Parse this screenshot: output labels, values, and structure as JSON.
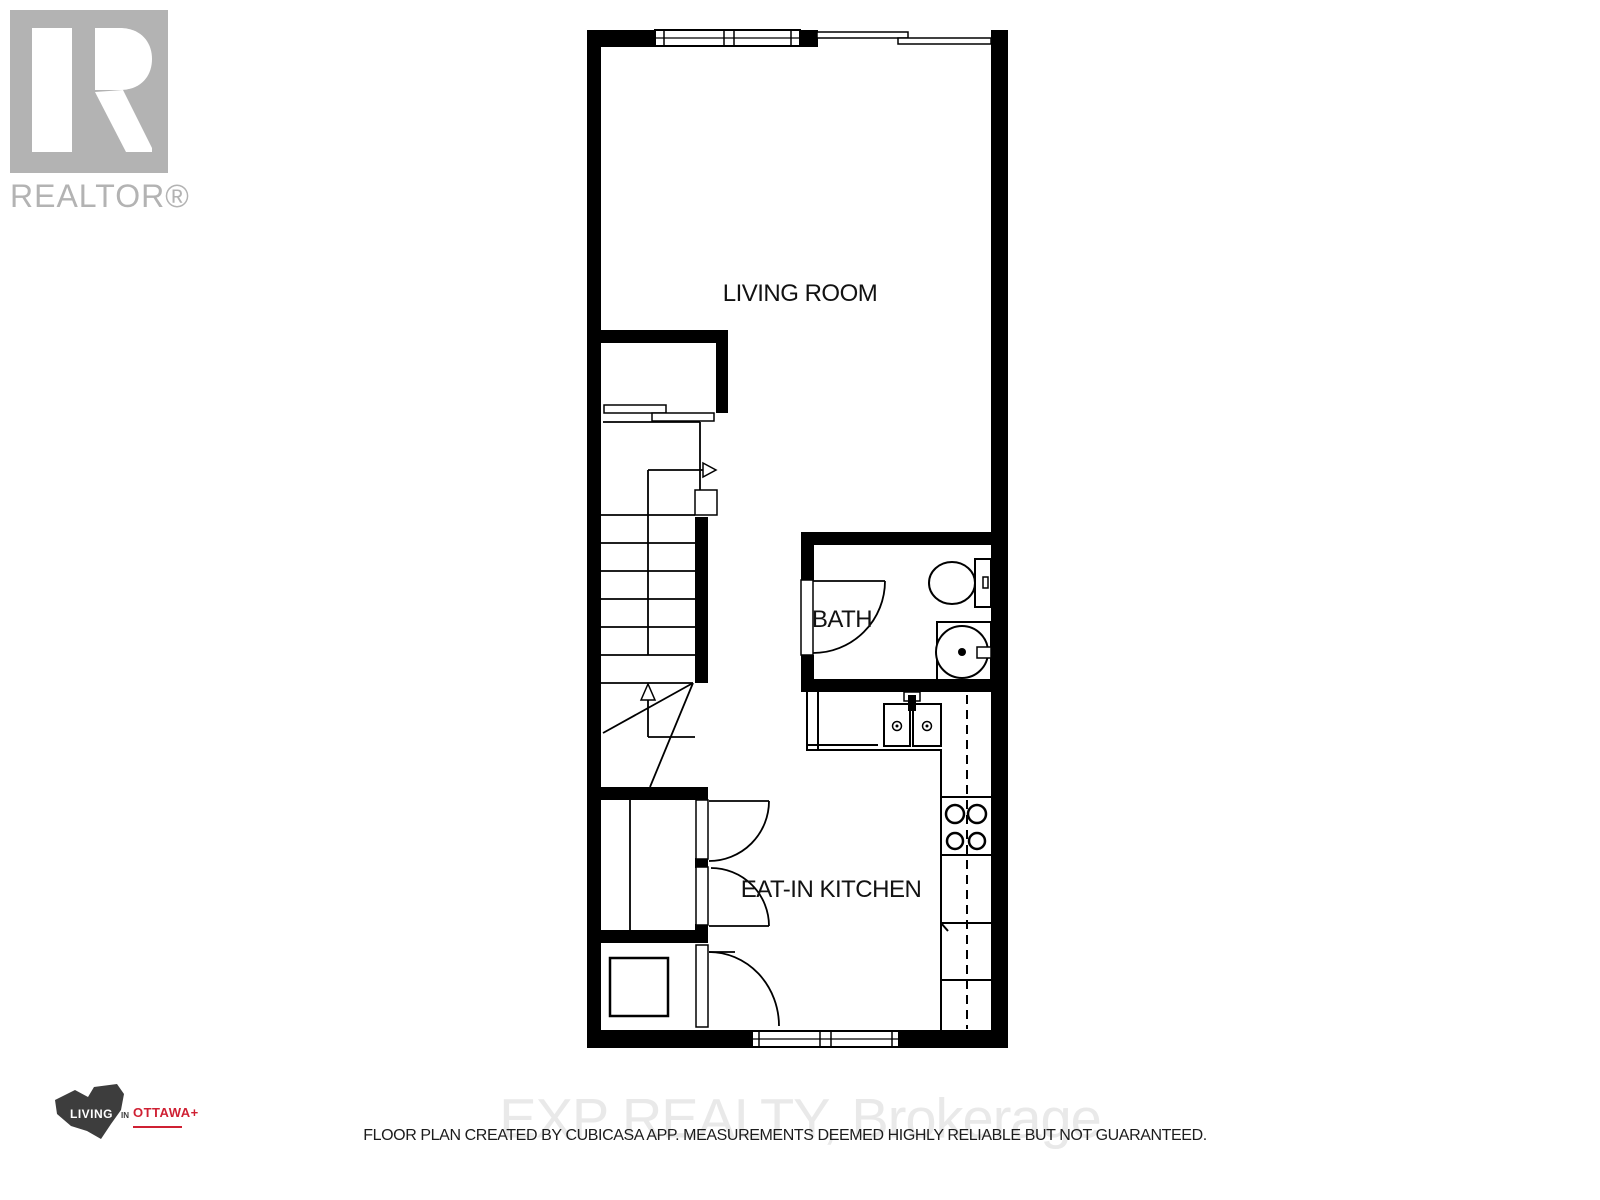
{
  "header": {
    "realtor_logo_label": "REALTOR®",
    "realtor_logo_color": "#b3b3b3"
  },
  "floor_plan": {
    "rooms": [
      {
        "label": "LIVING ROOM"
      },
      {
        "label": "BATH"
      },
      {
        "label": "EAT-IN KITCHEN"
      }
    ],
    "wall_color": "#000000",
    "fixtures": [
      "window",
      "sliding-patio-door",
      "closet-bypass-doors",
      "staircase",
      "stair-direction-arrow",
      "swing-door",
      "toilet",
      "bathroom-sink-vanity",
      "kitchen-sink",
      "cooktop-stove",
      "kitchen-counter",
      "upper-cabinet-dashed-line",
      "appliance",
      "bottom-window"
    ]
  },
  "footer": {
    "ottawa_logo": {
      "living": "LIVING",
      "in": "IN",
      "ottawa": "OTTAWA+",
      "accent_color": "#cf2033",
      "logo_color": "#3d3d3d"
    },
    "watermark": "EXP REALTY, Brokerage",
    "watermark_color": "#e9e9e9",
    "disclaimer": "FLOOR PLAN CREATED BY CUBICASA APP. MEASUREMENTS DEEMED HIGHLY RELIABLE BUT NOT GUARANTEED."
  }
}
